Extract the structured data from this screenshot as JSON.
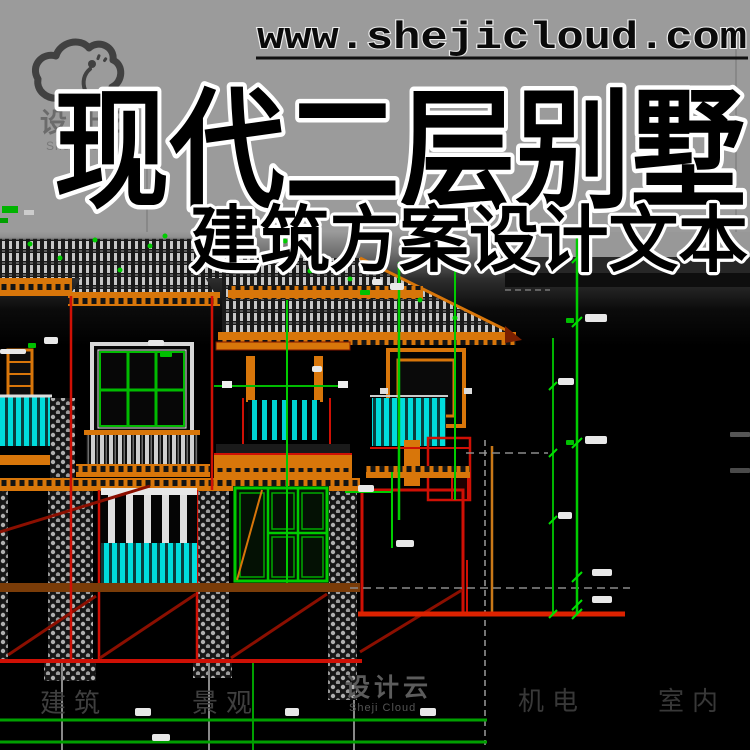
{
  "page": {
    "width": 750,
    "height": 750,
    "background": "#9b9b9b"
  },
  "header": {
    "url": "www.shejicloud.com"
  },
  "banner": {
    "title": "现代二层别墅",
    "subtitle": "建筑方案设计文本"
  },
  "logo": {
    "name_cn": "设计云",
    "name_en": "ShejiCloud"
  },
  "watermark": {
    "center_cn": "设计云",
    "center_en": "Sheji Cloud",
    "categories": [
      "建筑",
      "景观",
      "机电",
      "室内"
    ]
  },
  "drawing": {
    "colors": {
      "background": "#000000",
      "outline_red": "#cf1005",
      "dark_red": "#8b0f00",
      "dimension_green": "#00b400",
      "glass_cyan": "#00dcdc",
      "trim_orange": "#d8760a",
      "hatch_gray": "#c6c6c6",
      "stone_gray": "#b0b0b0"
    }
  }
}
